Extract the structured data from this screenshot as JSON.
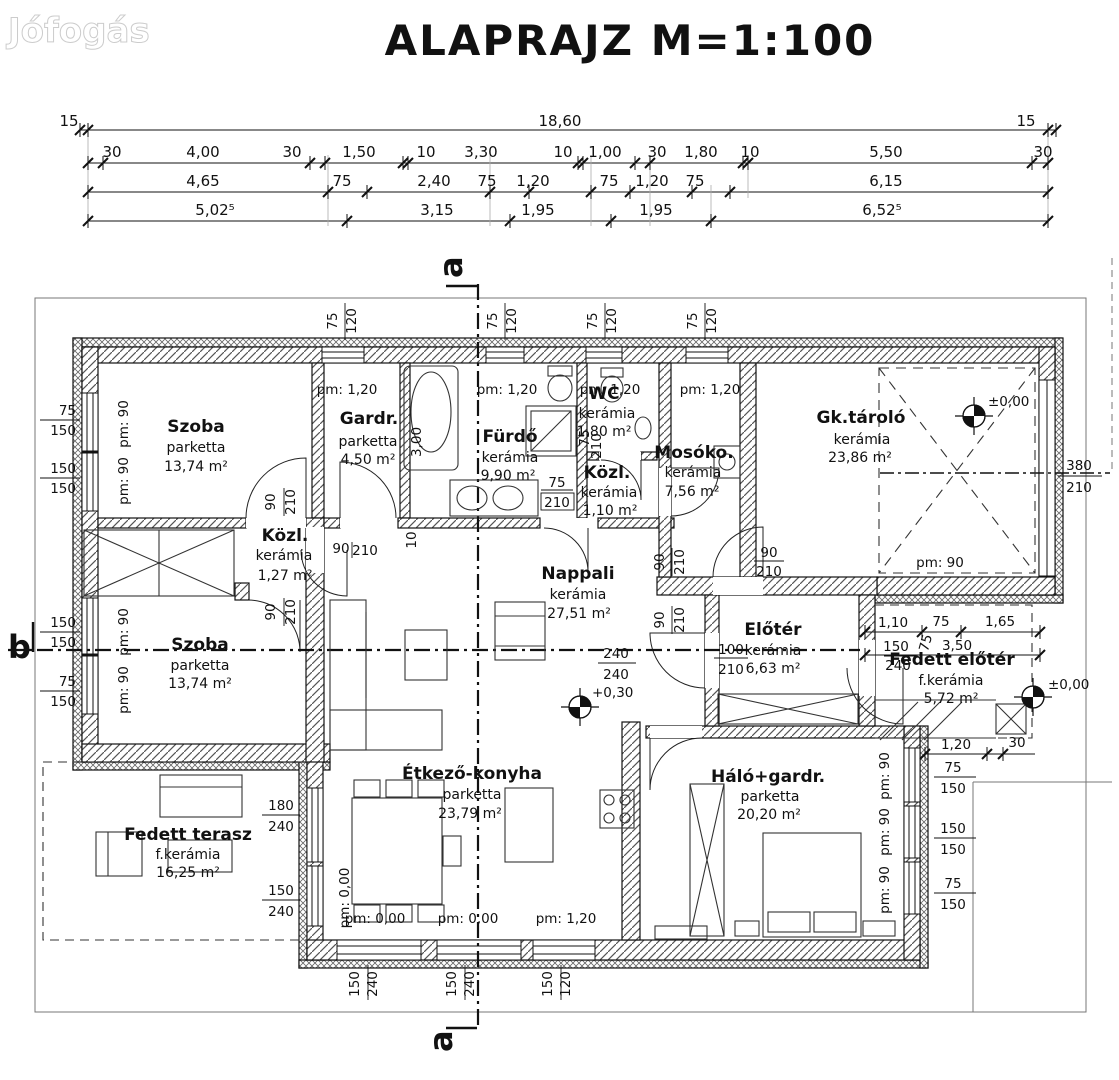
{
  "watermark": "Jófogás",
  "title": "ALAPRAJZ  M=1:100",
  "top_dims": {
    "overall_left": "15",
    "overall": "18,60",
    "overall_right": "15",
    "row2": [
      "30",
      "4,00",
      "30",
      "1,50",
      "10",
      "3,30",
      "10",
      "1,00",
      "30",
      "1,80",
      "10",
      "5,50",
      "30"
    ],
    "row3": [
      "4,65",
      "75",
      "2,40",
      "75",
      "1,20",
      "75",
      "1,20",
      "75",
      "6,15"
    ],
    "row4": [
      "5,02⁵",
      "3,15",
      "1,95",
      "1,95",
      "6,52⁵"
    ]
  },
  "sections": {
    "a": "a",
    "b": "b"
  },
  "rooms": {
    "szoba1": {
      "name": "Szoba",
      "floor": "parketta",
      "area": "13,74 m²"
    },
    "gardr": {
      "name": "Gardr.",
      "floor": "parketta",
      "area": "4,50 m²"
    },
    "furdo": {
      "name": "Fürdő",
      "floor": "kerámia",
      "area": "9,90 m²"
    },
    "wc": {
      "name": "WC",
      "floor": "kerámia",
      "area": "1,80 m²"
    },
    "mosoko": {
      "name": "Mosóko.",
      "floor": "kerámia",
      "area": "7,56 m²"
    },
    "gktarolo": {
      "name": "Gk.tároló",
      "floor": "kerámia",
      "area": "23,86 m²"
    },
    "kozl1": {
      "name": "Közl.",
      "floor": "kerámia",
      "area": "1,27 m²"
    },
    "kozl2": {
      "name": "Közl.",
      "floor": "kerámia",
      "area": "1,10 m²"
    },
    "nappali": {
      "name": "Nappali",
      "floor": "kerámia",
      "area": "27,51 m²"
    },
    "eloter": {
      "name": "Előtér",
      "floor": "kerámia",
      "area": "6,63 m²"
    },
    "fedett_eloter": {
      "name": "Fedett előtér",
      "floor": "f.kerámia",
      "area": "5,72 m²"
    },
    "szoba2": {
      "name": "Szoba",
      "floor": "parketta",
      "area": "13,74 m²"
    },
    "etkezo": {
      "name": "Étkező-konyha",
      "floor": "parketta",
      "area": "23,79 m²"
    },
    "halo": {
      "name": "Háló+gardr.",
      "floor": "parketta",
      "area": "20,20 m²"
    },
    "terasz": {
      "name": "Fedett terasz",
      "floor": "f.kerámia",
      "area": "16,25 m²"
    }
  },
  "levels": {
    "garage": "±0,00",
    "porch": "±0,00",
    "nappali": "+0,30"
  },
  "pm": {
    "gardr": "pm: 1,20",
    "furdo": "pm: 1,20",
    "wc": "pm: 1,20",
    "mosoko": "pm: 1,20",
    "left1": "pm: 90",
    "left2": "pm: 90",
    "left3": "pm: 90",
    "left4": "pm: 90",
    "garage": "pm: 90",
    "halo1": "pm: 90",
    "halo2": "pm: 90",
    "halo3": "pm: 90",
    "terasz_v": "pm: 0,00",
    "bottom1": "pm: 0,00",
    "bottom2": "pm: 0,00",
    "bottom3": "pm: 1,20"
  },
  "win": {
    "top": [
      "75",
      "120"
    ],
    "left1": [
      "75",
      "150"
    ],
    "left2": [
      "150",
      "150"
    ],
    "left3": [
      "150",
      "150"
    ],
    "left4": [
      "75",
      "150"
    ],
    "right1": [
      "75",
      "150"
    ],
    "right2": [
      "150",
      "150"
    ],
    "right3": [
      "75",
      "150"
    ],
    "bottom1": [
      "150",
      "240"
    ],
    "bottom2": [
      "150",
      "240"
    ],
    "bottom3": [
      "150",
      "120"
    ],
    "garage_door": [
      "380",
      "210"
    ]
  },
  "doors": {
    "szoba1": [
      "90",
      "210"
    ],
    "szoba2": [
      "90",
      "210"
    ],
    "kozl1": [
      "90",
      "210"
    ],
    "furdo": [
      "75",
      "210"
    ],
    "wc": [
      "75",
      "210"
    ],
    "nappali_a": [
      "90",
      "210"
    ],
    "nappali_b": [
      "90",
      "210"
    ],
    "nappali_c": [
      "90",
      "210"
    ],
    "eloter": [
      "100",
      "210"
    ]
  },
  "misc": {
    "bath_len": "3,00",
    "small": "10",
    "nappali_pair": [
      "240",
      "240"
    ],
    "porch_row1": [
      "1,10",
      "75",
      "1,65"
    ],
    "porch_width": "3,50",
    "porch_rot": "75",
    "porch_pair": [
      "150",
      "240"
    ],
    "entry_row": [
      "1,20",
      "30"
    ],
    "terasz_pair1": [
      "180",
      "240"
    ],
    "terasz_pair2": [
      "150",
      "240"
    ]
  }
}
